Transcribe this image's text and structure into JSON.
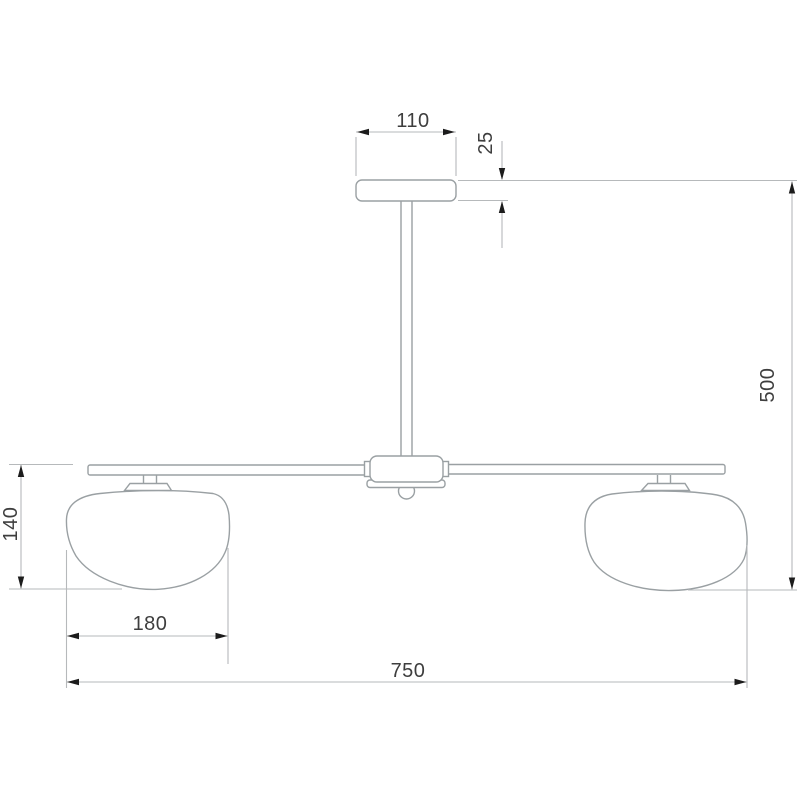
{
  "drawing": {
    "type": "technical-dimension-drawing",
    "subject": "two-shade ceiling pendant lamp, front elevation",
    "dimensions": {
      "canopy_width": "110",
      "canopy_thickness": "25",
      "overall_height": "500",
      "shade_height": "140",
      "shade_width": "180",
      "overall_width": "750"
    },
    "colors": {
      "background": "#ffffff",
      "outline": "#9aa0a3",
      "dimension_line": "#b6b9bb",
      "arrow": "#1c1c1c",
      "text": "#3e3e3e"
    }
  }
}
